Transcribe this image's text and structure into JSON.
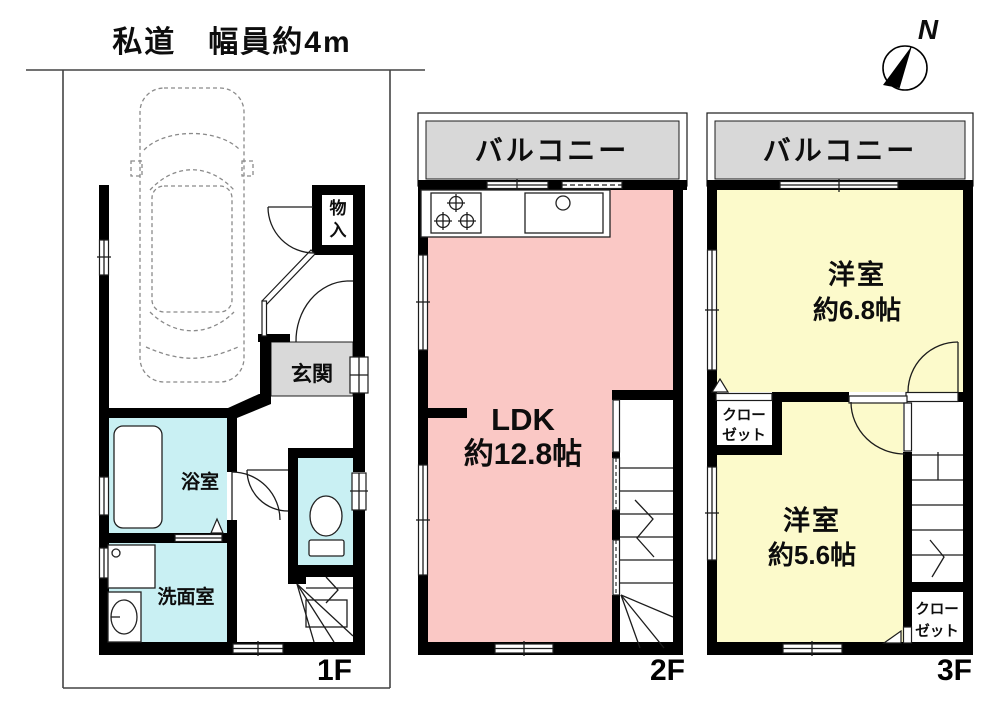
{
  "road_label": "私道　幅員約4m",
  "compass": {
    "north": "N"
  },
  "colors": {
    "pink": "#fac8c5",
    "yellow": "#fcfacb",
    "cyan": "#c9f0f3",
    "gray": "#d9d9d9",
    "balcony": "#d8d8d8"
  },
  "floor1": {
    "label": "1F",
    "storage_l1": "物",
    "storage_l2": "入",
    "entrance": "玄関",
    "bath": "浴室",
    "washroom": "洗面室"
  },
  "floor2": {
    "label": "2F",
    "balcony": "バルコニー",
    "ldk": "LDK",
    "ldk_size": "約12.8帖"
  },
  "floor3": {
    "label": "3F",
    "balcony": "バルコニー",
    "room_a": "洋室",
    "room_a_size": "約6.8帖",
    "room_b": "洋室",
    "room_b_size": "約5.6帖",
    "closet_a_l1": "クロー",
    "closet_a_l2": "ゼット",
    "closet_b_l1": "クロー",
    "closet_b_l2": "ゼット"
  }
}
